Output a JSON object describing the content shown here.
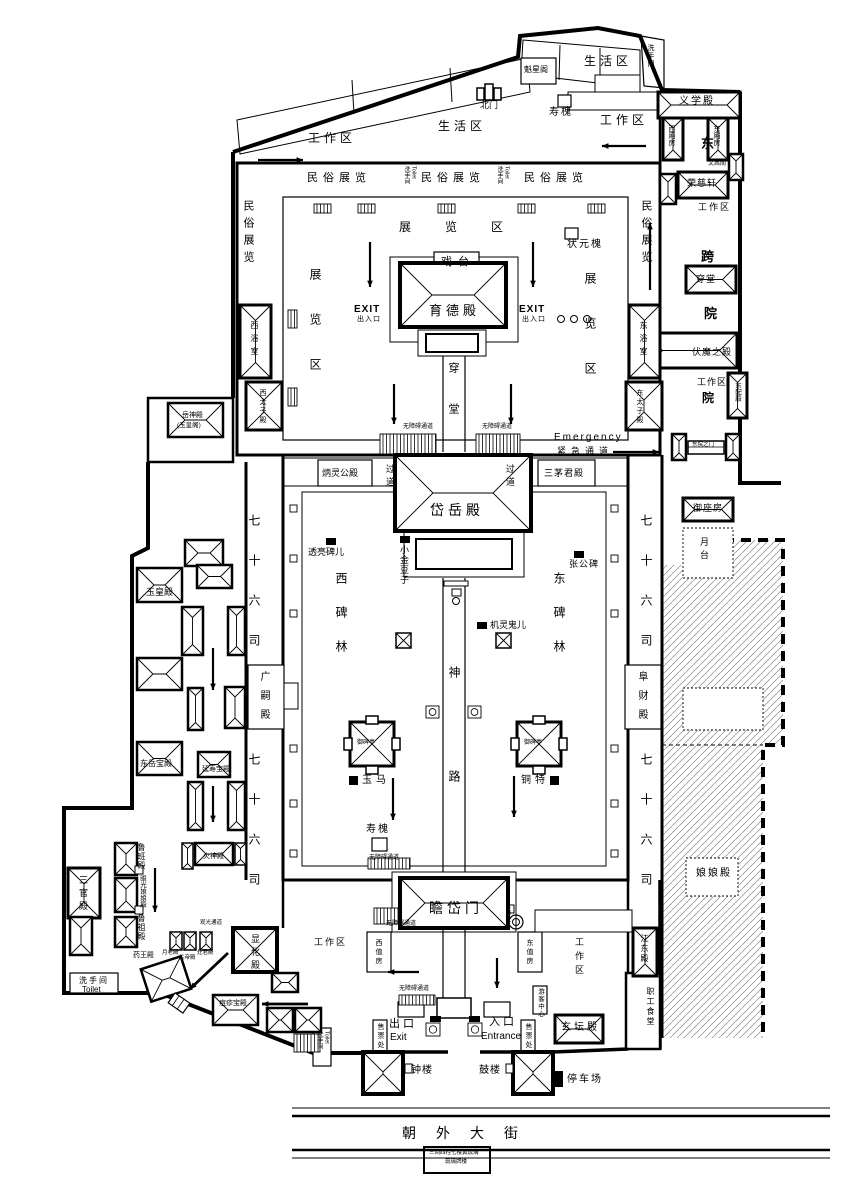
{
  "colors": {
    "ink": "#000000",
    "paper": "#ffffff"
  },
  "areas": {
    "living_area": "生活区",
    "work_area": "工作区",
    "exhibit_strip": "民俗展览",
    "exhibit_zone": "展览区",
    "restroom_cn": "洗手间",
    "restroom_en": "Toilet",
    "passage": "过道",
    "accessible_path": "无障碍通道",
    "emergency_en": "Emergency",
    "emergency_cn": "紧急通道",
    "exit_en": "EXIT",
    "exit_cn": "出入口",
    "south_exit_cn": "出口",
    "south_exit_en": "Exit",
    "south_entrance_cn": "入口",
    "south_entrance_en": "Entrance",
    "ticket_office": "售票处",
    "visitor_center": "游客中心",
    "parking": "停车场",
    "sight_path": "观光通道",
    "street": "朝外大街"
  },
  "halls": {
    "kuixingge": "魁星阁",
    "beimen": "北门",
    "shouhuai": "寿槐",
    "yixuedian": "义学殿",
    "xixiangfang": "西厢房",
    "dongxiangfang": "东厢房",
    "wenchangge": "文昌阁",
    "rongcixuan": "荣慈轩",
    "chuantang": "穿堂",
    "fumozhidian": "伏魔之殿",
    "dongpeidian": "东配殿",
    "dongyuan_gate": "东院之门",
    "yuzuofang": "御座房",
    "yuetai": "月台",
    "niangniangdian": "娘娘殿",
    "xitai": "戏台",
    "yudedian": "育德殿",
    "zhuangyuanhuai": "状元槐",
    "xiyushi": "西浴室",
    "dongyushi": "东浴室",
    "xitaizidian": "西太子殿",
    "dongtaizidian": "东太子殿",
    "binglinggongdian": "炳灵公殿",
    "sanmaojundian": "三茅君殿",
    "daiyuedian": "岱岳殿",
    "yueshendian": "岳神殿",
    "yuhuangge": "(玉皇阁)",
    "touliangbeir": "透亮碑儿",
    "xiaojindouzi": "小金豆子",
    "zhanggongbei": "张公碑",
    "jilingguir": "机灵鬼儿",
    "xibeilin": "西碑林",
    "dongbeilin": "东碑林",
    "shenlu": "神路",
    "yubeiting": "御碑亭",
    "yuma": "玉马",
    "tongte": "铜特",
    "qishiliusi": "七十六司",
    "guangsidian": "广嗣殿",
    "fucaidian": "阜财殿",
    "yuhuangdian": "玉皇殿",
    "dongyuebaodian": "东岳宝殿",
    "yanshoubaodian": "延寿宝殿",
    "huoshendian": "火神殿",
    "sanguandian": "三官殿",
    "lubandian": "鲁班殿",
    "yanguangdian": "眼光娘娘殿",
    "luzudian": "鲁祖殿",
    "yaowangdian": "药王殿",
    "yuelaodian": "月老殿",
    "guandidian": "关帝殿",
    "zaojundian": "灶君殿",
    "xianhuadian": "显化殿",
    "douzhenbaodian": "痘疹宝殿",
    "zhandaimen": "瞻岱门",
    "xizhifang": "西值房",
    "dongzhifang": "东值房",
    "taipinggang": "太平缸",
    "xuantandian": "玄坛殿",
    "jiangdongdian": "江东殿",
    "zhigongshitang": "职工食堂",
    "zhonglou": "钟楼",
    "gulou": "鼓楼",
    "char_dong": "东",
    "char_kua": "跨",
    "char_yuan": "院",
    "pailou_line1": "三间四柱七楼黄琉璃",
    "pailou_line2": "琉璃牌楼"
  }
}
